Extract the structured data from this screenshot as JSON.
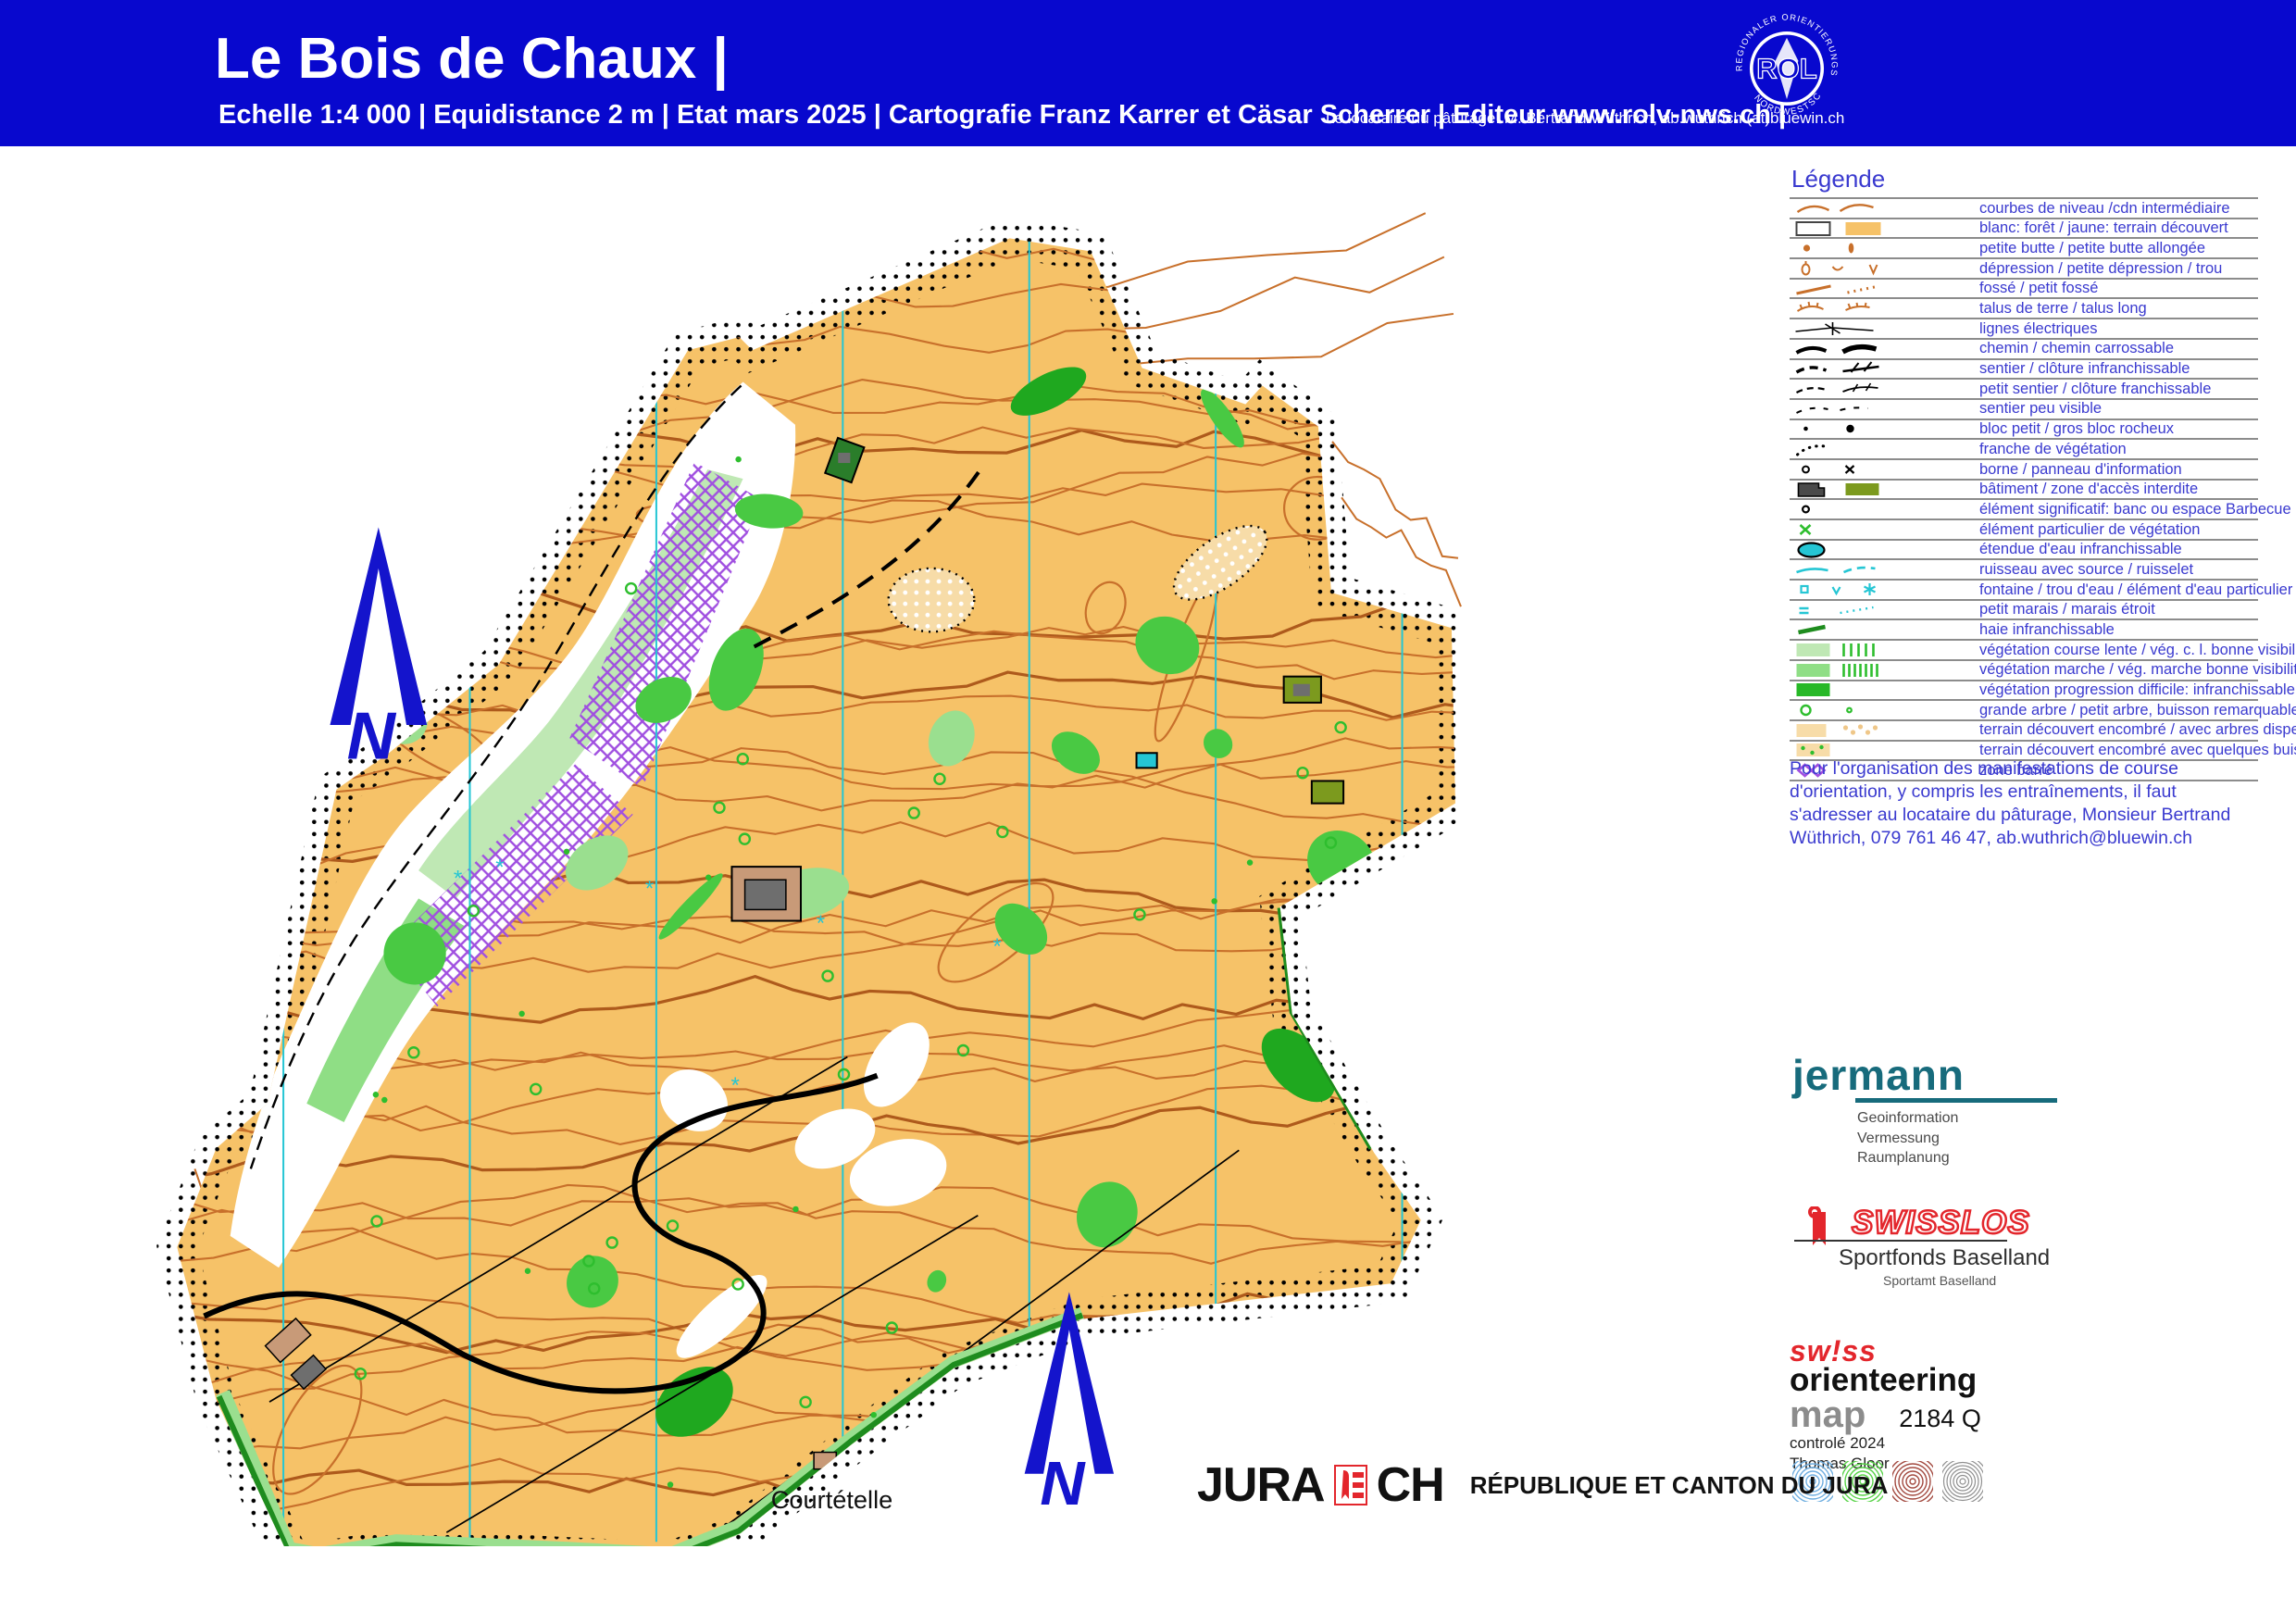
{
  "header": {
    "title": "Le Bois de Chaux |",
    "subtitle": "Echelle 1:4 000 | Equidistance 2 m | Etat mars 2025 | Cartografie Franz Karrer et Cäsar Scherrer | Editeur www.rolv-nws.ch |",
    "pasture_note": "Le locataire du pâturage: M. Bertrand Wüthrich, ab.wuthrich (at)bluewin.ch",
    "background_color": "#0808CE"
  },
  "rolv_logo": {
    "arc_top": "REGIONALER ORIENTIERUNGSLAUF - VERBAND",
    "arc_bottom": "NORDWESTSCHWEIZ",
    "center": "ROL"
  },
  "legend": {
    "title": "Légende",
    "items": [
      {
        "icon": "contours",
        "label": "courbes de niveau /cdn intermédiaire"
      },
      {
        "icon": "forest",
        "label": "blanc: forêt / jaune: terrain découvert"
      },
      {
        "icon": "butte",
        "label": "petite butte / petite butte allongée"
      },
      {
        "icon": "depression",
        "label": "dépression / petite dépression / trou"
      },
      {
        "icon": "fosse",
        "label": "fossé / petit fossé"
      },
      {
        "icon": "talus",
        "label": "talus de terre / talus long"
      },
      {
        "icon": "power",
        "label": "lignes électriques"
      },
      {
        "icon": "chemin",
        "label": "chemin / chemin carrossable"
      },
      {
        "icon": "sentier",
        "label": "sentier / clôture infranchissable"
      },
      {
        "icon": "petit-sentier",
        "label": "petit sentier / clôture franchissable"
      },
      {
        "icon": "sentier-peu",
        "label": "sentier peu visible"
      },
      {
        "icon": "blocs",
        "label": "bloc petit / gros bloc rocheux"
      },
      {
        "icon": "franche",
        "label": "franche de végétation"
      },
      {
        "icon": "borne",
        "label": "borne / panneau d'information"
      },
      {
        "icon": "batiment",
        "label": "bâtiment / zone d'accès interdite"
      },
      {
        "icon": "banc",
        "label": "élément significatif: banc ou espace Barbecue"
      },
      {
        "icon": "vegx",
        "label": "élément particulier de végétation"
      },
      {
        "icon": "etendue",
        "label": "étendue d'eau infranchissable"
      },
      {
        "icon": "ruisseau",
        "label": "ruisseau avec source / ruisselet"
      },
      {
        "icon": "fontaine",
        "label": "fontaine / trou d'eau / élément d'eau particulier"
      },
      {
        "icon": "marais",
        "label": "petit marais / marais étroit"
      },
      {
        "icon": "haie",
        "label": "haie infranchissable"
      },
      {
        "icon": "veg-lente",
        "label": "végétation course lente / vég. c. l. bonne visibilité"
      },
      {
        "icon": "veg-marche",
        "label": "végétation marche / vég. marche bonne visibilité"
      },
      {
        "icon": "veg-diff",
        "label": "végétation progression difficile: infranchissable"
      },
      {
        "icon": "arbres",
        "label": "grande arbre / petit arbre, buisson remarquable"
      },
      {
        "icon": "rough-open",
        "label": "terrain découvert encombré / avec arbres dispersés"
      },
      {
        "icon": "rough-bushes",
        "label": "terrain découvert encombré avec quelques buissons"
      },
      {
        "icon": "zone-barre",
        "label": "zone barré"
      }
    ]
  },
  "org_note": "Pour l'organisation des manifestations de course d'orientation, y compris les entraînements, il faut s'adresser au locataire du pâturage, Monsieur Bertrand Wüthrich, 079 761 46 47, ab.wuthrich@bluewin.ch",
  "jermann": {
    "name": "jermann",
    "lines": [
      "Geoinformation",
      "Vermessung",
      "Raumplanung"
    ],
    "color": "#176B7C"
  },
  "swisslos": {
    "word": "SWISSLOS",
    "sub": "Sportfonds Baselland",
    "sub2": "Sportamt Baselland",
    "color": "#E3262C"
  },
  "swiss_orienteering": {
    "line1": "sw!ss",
    "line2": "orienteering",
    "line3": "map",
    "code": "2184 Q",
    "checked": "controlé 2024",
    "checker": "Thomas Gloor"
  },
  "jura": {
    "word": "JURA",
    "ch": "CH",
    "caption": "RÉPUBLIQUE ET CANTON DU JURA"
  },
  "map": {
    "town_label": "Courtételle",
    "north_label": "N",
    "colors": {
      "open_yellow": "#F6C268",
      "contour_brown": "#C8702B",
      "meridian_cyan": "#25C6D4",
      "forbidden_purple": "#A04FE0",
      "north_blue": "#1414CC"
    }
  }
}
